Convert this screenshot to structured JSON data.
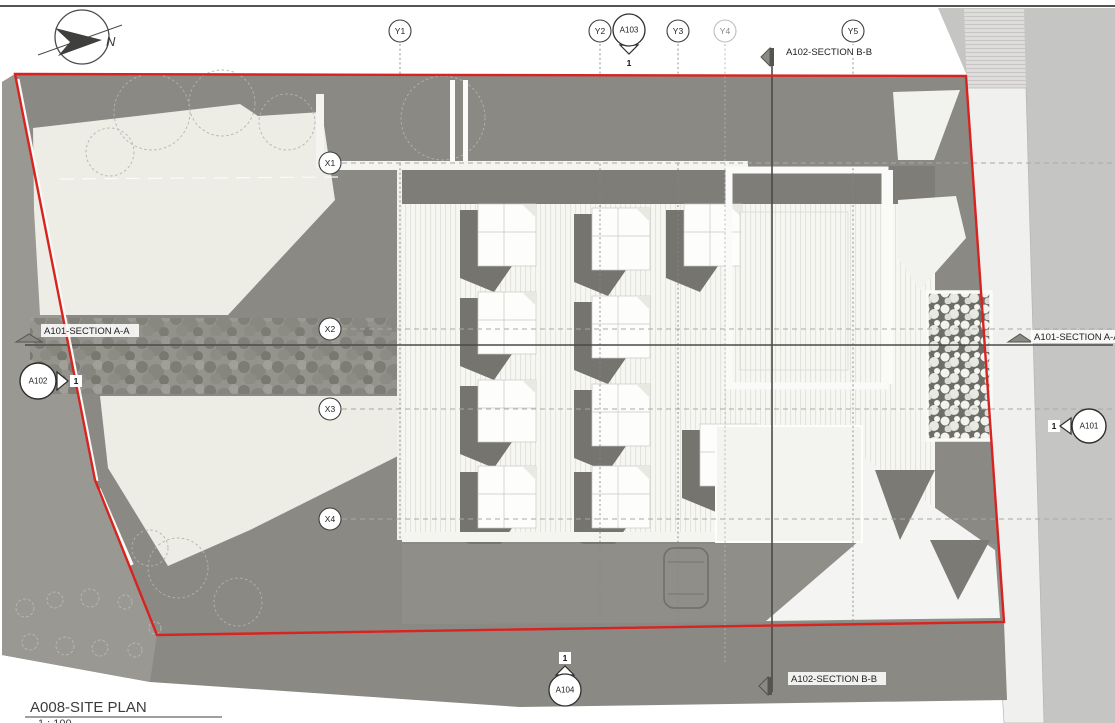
{
  "titleblock": {
    "title": "A008-SITE PLAN",
    "scale": "1 : 100"
  },
  "north_label": "N",
  "grid": {
    "y_labels": [
      "Y1",
      "Y2",
      "Y3",
      "Y4",
      "Y5"
    ],
    "x_labels": [
      "X1",
      "X2",
      "X3",
      "X4"
    ]
  },
  "sections": {
    "bb_top": "A102-SECTION B-B",
    "bb_bottom": "A102-SECTION B-B",
    "aa_left": "A101-SECTION A-A",
    "aa_right": "A101-SECTION A-A"
  },
  "callouts": {
    "a103": {
      "sheet": "A103",
      "detail": "1"
    },
    "a104": {
      "sheet": "A104",
      "detail": "1"
    },
    "a102": {
      "sheet": "A102",
      "detail": "1"
    },
    "a101": {
      "sheet": "A101",
      "detail": "1"
    }
  },
  "colors": {
    "boundary_red": "#d92320",
    "site_gray": "#8a8984",
    "shadow_gray": "#7b7a75",
    "lawn": "#edece5",
    "roof_light": "#f6f6f3",
    "street_gray": "#c5c5c4",
    "sidewalk": "#f0f0ee"
  }
}
